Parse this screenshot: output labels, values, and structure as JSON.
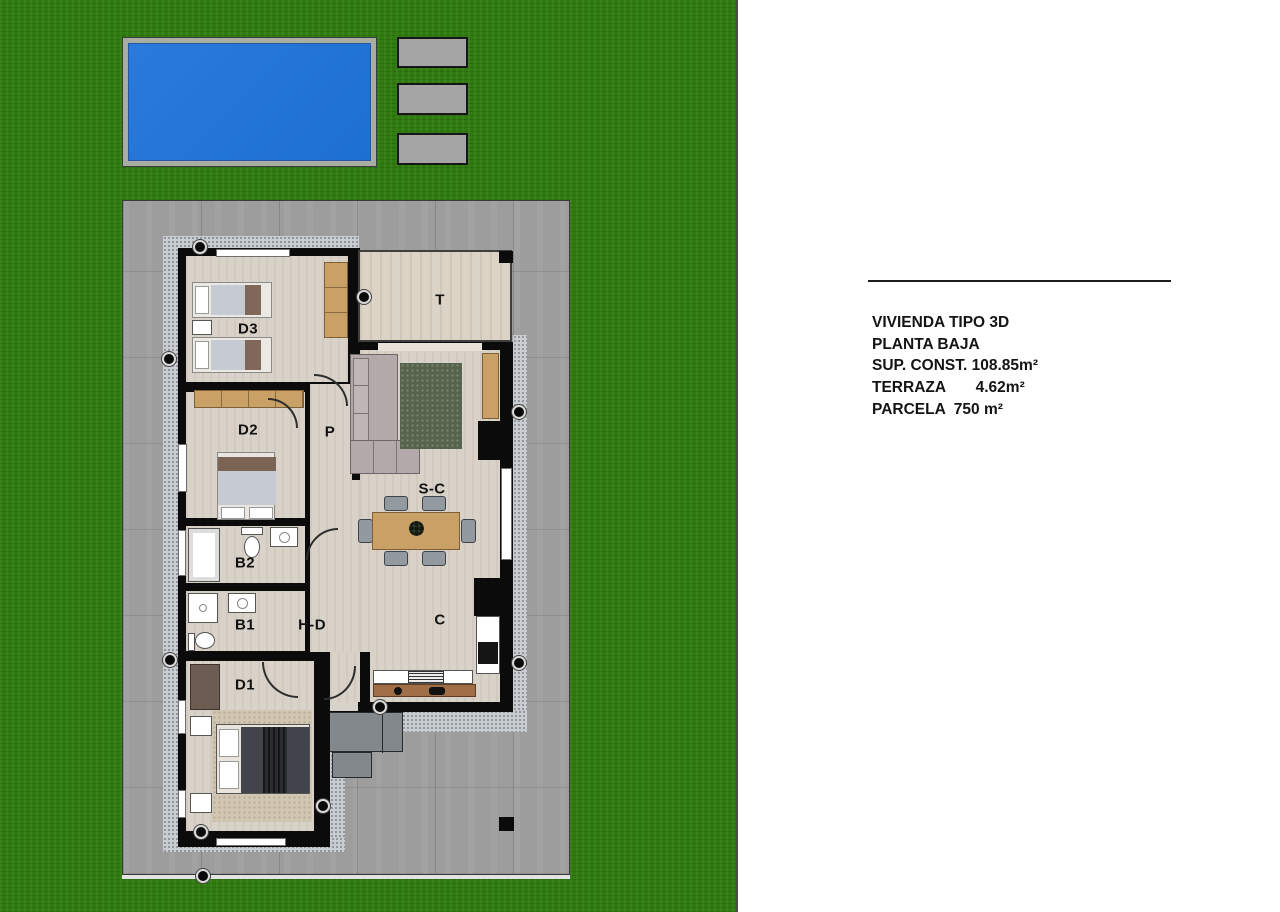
{
  "plan": {
    "labels": {
      "d3": "D3",
      "d2": "D2",
      "d1": "D1",
      "b2": "B2",
      "b1": "B1",
      "p": "P",
      "t": "T",
      "sc": "S-C",
      "hd": "H-D",
      "c": "C"
    }
  },
  "info": {
    "lines": [
      "VIVIENDA TIPO 3D",
      "PLANTA BAJA",
      "SUP. CONST. 108.85m²",
      "TERRAZA       4.62m²",
      "PARCELA  750 m²"
    ]
  },
  "colors": {
    "grass": "#2f7b10",
    "pool": "#1e6fd2",
    "poolEdge": "#a9aea3",
    "pad": "#a5a5a5",
    "plot": "#9d9d9d",
    "walk": "#c9cdd2",
    "wall": "#0b0b0b",
    "floor": "#d9d2c9",
    "terrace": "#dbd4c6",
    "wood": "#c9a166",
    "rugGreen": "#56644e",
    "rugBeige": "#d0c6b2",
    "sofa": "#b3a9aa",
    "chair": "#939a9f",
    "duvet": "#41454b",
    "counter": "#a06f47",
    "steps": "#83888d"
  }
}
